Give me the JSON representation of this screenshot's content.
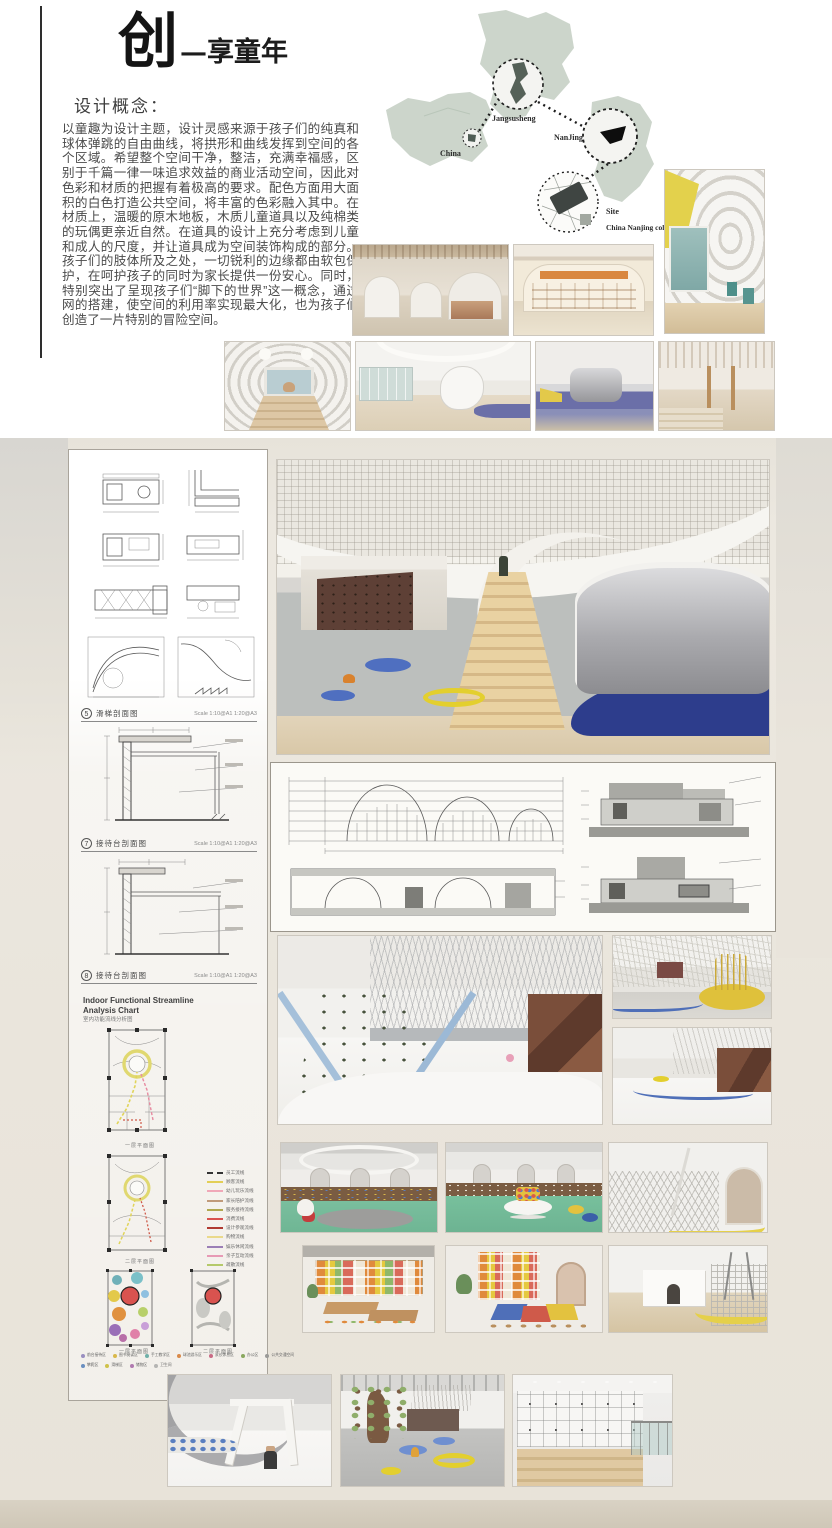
{
  "header": {
    "title_big": "创",
    "title_rest": "—享童年",
    "concept_heading": "设计概念：",
    "concept_body": "以童趣为设计主题，设计灵感来源于孩子们的纯真和球体弹跳的自由曲线，将拱形和曲线发挥到空间的各个区域。希望整个空间干净，整洁，充满幸福感，区别于千篇一律一味追求效益的商业活动空间，因此对色彩和材质的把握有着极高的要求。配色方面用大面积的白色打造公共空间，将丰富的色彩融入其中。在材质上，温暖的原木地板，木质儿童道具以及纯棉类的玩偶更亲近自然。在道具的设计上充分考虑到儿童和成人的尺度，并让道具成为空间装饰构成的部分。孩子们的肢体所及之处，一切锐利的边缘都由软包保护，在呵护孩子的同时为家长提供一份安心。同时，特别突出了呈现孩子们“脚下的世界”这一概念，通过网的搭建，使空间的利用率实现最大化，也为孩子们创造了一片特别的冒险空间。"
  },
  "map": {
    "china_label": "China",
    "province_label": "Jangsusheng",
    "city_label": "NanJing",
    "site_label": "Site",
    "site_caption": "China Nanjing colorful world"
  },
  "drawings": {
    "slide_a": {
      "index": "5",
      "label": "滑梯剖面图",
      "scale": "Scale 1:10@A1 1:20@A3"
    },
    "slide_b": {
      "index": "6",
      "label": "滑梯剖面图",
      "scale": "Scale 1:10@A1 1:20@A3"
    },
    "desk_a": {
      "index": "7",
      "label": "接待台剖面图",
      "scale": "Scale 1:10@A1 1:20@A3"
    },
    "desk_b": {
      "index": "8",
      "label": "接待台剖面图",
      "scale": "Scale 1:10@A1 1:20@A3"
    }
  },
  "analysis": {
    "title_line1": "Indoor Functional Streamline",
    "title_line2": "Analysis Chart",
    "subtitle_cn": "室内功能流线分析图",
    "plan1_caption": "一层平面图",
    "plan2_caption": "二层平面图",
    "bubble1_caption": "一层平面图",
    "bubble2_caption": "二层平面图",
    "legend": [
      {
        "label": "员工流线",
        "color": "#333333",
        "style": "dashed"
      },
      {
        "label": "顾客流线",
        "color": "#e3cf56",
        "style": "solid"
      },
      {
        "label": "幼儿玩乐流线",
        "color": "#f0a8b8",
        "style": "solid"
      },
      {
        "label": "家长陪护流线",
        "color": "#c09a7a",
        "style": "solid"
      },
      {
        "label": "服务接待流线",
        "color": "#b0a84f",
        "style": "solid"
      },
      {
        "label": "消费流线",
        "color": "#d9534f",
        "style": "solid"
      },
      {
        "label": "设计参观流线",
        "color": "#b03a32",
        "style": "solid"
      },
      {
        "label": "购物流线",
        "color": "#ead98b",
        "style": "solid"
      },
      {
        "label": "娱乐休闲流线",
        "color": "#9b7fb6",
        "style": "solid"
      },
      {
        "label": "亲子互动流线",
        "color": "#e79ab5",
        "style": "solid"
      },
      {
        "label": "疏散流线",
        "color": "#b5c96a",
        "style": "solid"
      }
    ],
    "zones_row1": [
      {
        "label": "前台接待区",
        "color": "#9a8fc0"
      },
      {
        "label": "图书阅读区",
        "color": "#d9b84a"
      },
      {
        "label": "手工教学区",
        "color": "#6fb0a8"
      },
      {
        "label": "球池游乐区",
        "color": "#d98a4a"
      },
      {
        "label": "家长休息区",
        "color": "#c96a85"
      },
      {
        "label": "办公区",
        "color": "#8aa85f"
      },
      {
        "label": "公共交通空间",
        "color": "#9a9a98"
      }
    ],
    "zones_row2": [
      {
        "label": "攀爬区",
        "color": "#6a8fc0"
      },
      {
        "label": "滑梯区",
        "color": "#cfc24a"
      },
      {
        "label": "储物区",
        "color": "#b07ab0"
      },
      {
        "label": "卫生间",
        "color": "#b5b5b3"
      }
    ]
  }
}
